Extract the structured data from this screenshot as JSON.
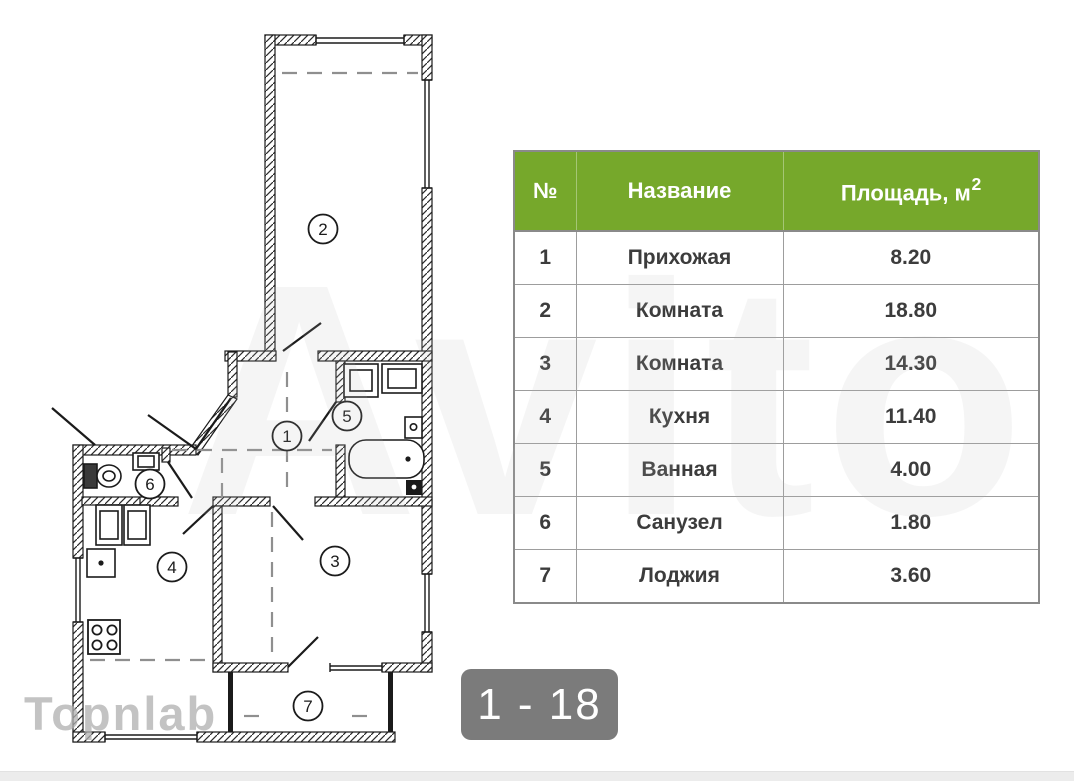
{
  "watermarks": {
    "brand": "Avito",
    "agency": "Topnlab"
  },
  "gallery": {
    "pager_badge": "1 - 18",
    "badge_bg": "#7b7b7b",
    "badge_text_color": "#ffffff"
  },
  "table": {
    "header_bg": "#76a82b",
    "header_text_color": "#ffffff",
    "columns": {
      "num": "№",
      "name": "Название",
      "area": "Площадь, м",
      "area_sup": "2"
    },
    "rows": [
      {
        "num": "1",
        "name": "Прихожая",
        "area": "8.20"
      },
      {
        "num": "2",
        "name": "Комната",
        "area": "18.80"
      },
      {
        "num": "3",
        "name": "Комната",
        "area": "14.30"
      },
      {
        "num": "4",
        "name": "Кухня",
        "area": "11.40"
      },
      {
        "num": "5",
        "name": "Ванная",
        "area": "4.00"
      },
      {
        "num": "6",
        "name": "Санузел",
        "area": "1.80"
      },
      {
        "num": "7",
        "name": "Лоджия",
        "area": "3.60"
      }
    ]
  },
  "floor_plan": {
    "room_markers": [
      "1",
      "2",
      "3",
      "4",
      "5",
      "6",
      "7"
    ]
  }
}
